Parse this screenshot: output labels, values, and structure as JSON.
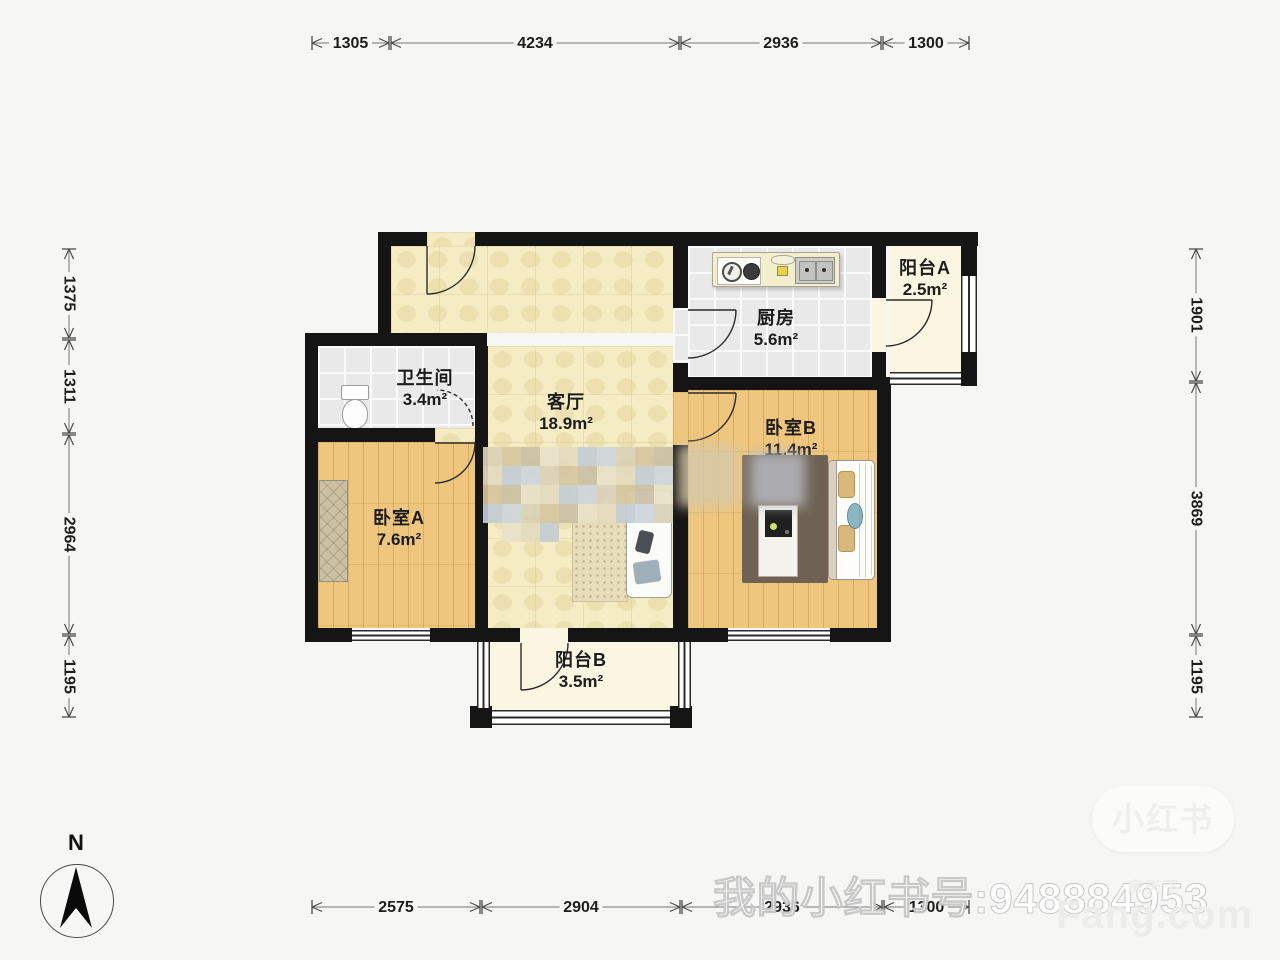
{
  "plan": {
    "rooms": [
      {
        "id": "living",
        "name": "客厅",
        "area": "18.9m²"
      },
      {
        "id": "kitchen",
        "name": "厨房",
        "area": "5.6m²"
      },
      {
        "id": "bathroom",
        "name": "卫生间",
        "area": "3.4m²"
      },
      {
        "id": "bedroomA",
        "name": "卧室A",
        "area": "7.6m²"
      },
      {
        "id": "bedroomB",
        "name": "卧室B",
        "area": "11.4m²"
      },
      {
        "id": "balconyA",
        "name": "阳台A",
        "area": "2.5m²"
      },
      {
        "id": "balconyB",
        "name": "阳台B",
        "area": "3.5m²"
      }
    ],
    "dimensions": {
      "top": [
        "1305",
        "4234",
        "2936",
        "1300"
      ],
      "bottom": [
        "2575",
        "2904",
        "2936",
        "1300"
      ],
      "left": [
        "1375",
        "1311",
        "2964",
        "1195"
      ],
      "right": [
        "1901",
        "3869",
        "1195"
      ]
    },
    "compass": {
      "label": "N"
    }
  },
  "watermarks": {
    "xiaohongshu_id": "我的小红书号:948884953",
    "fang_logo": "Fang.com",
    "fang_cn": "房天下",
    "badge": "小红书"
  },
  "colors": {
    "wall": "#151515",
    "living_floor": "#f5ecc4",
    "wood_floor": "#efc67d",
    "tile_floor": "#e9e9e9",
    "balcony_floor": "#faf6e1",
    "background": "#f6f6f4"
  }
}
